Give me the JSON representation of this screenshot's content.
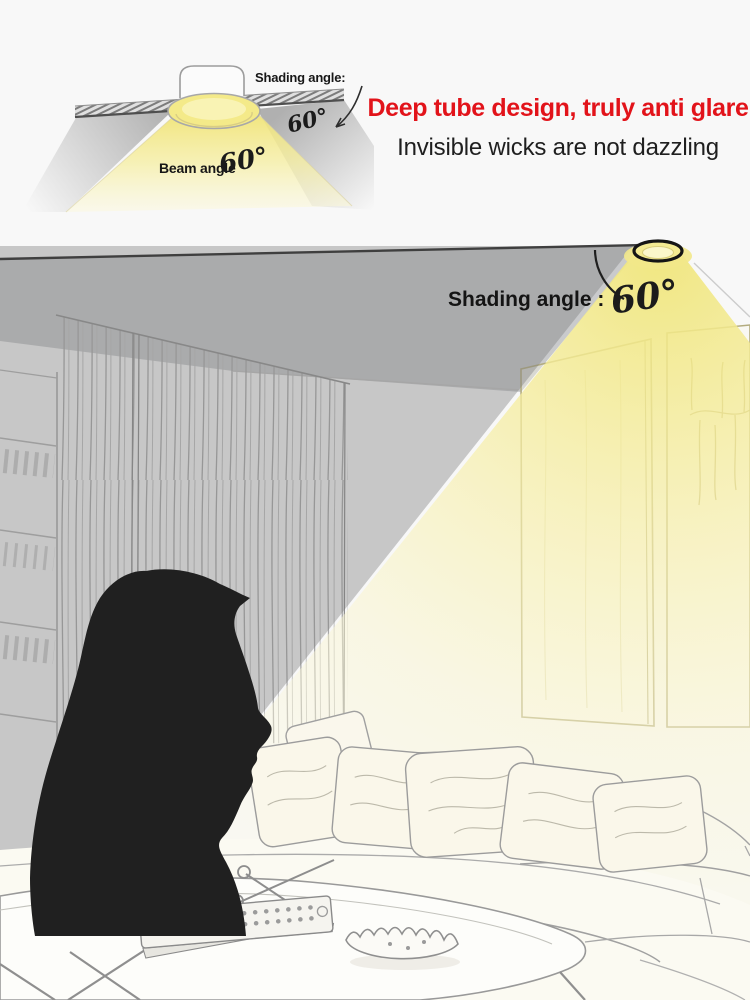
{
  "header": {
    "headline": "Deep tube design, truly anti glare",
    "subheadline": "Invisible wicks are not dazzling"
  },
  "diagram": {
    "shading_angle_label": "Shading angle:",
    "shading_angle_value": "60°",
    "beam_angle_label": "Beam angle",
    "beam_angle_value": "60°"
  },
  "room": {
    "shading_angle_label": "Shading angle :",
    "shading_angle_value": "60°"
  },
  "colors": {
    "accent_red": "#e2131a",
    "beam_yellow": "#f2e88a",
    "shadow_gray": "#bdbdbd",
    "silhouette_black": "#202020"
  }
}
